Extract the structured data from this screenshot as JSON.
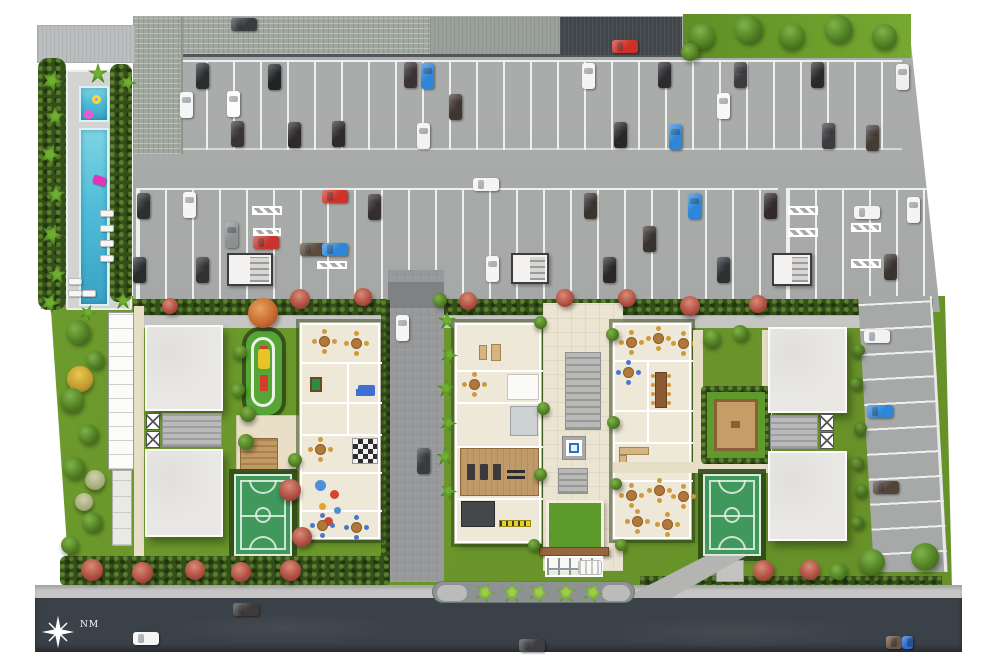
{
  "compass": {
    "label": "NM"
  },
  "palette": {
    "parking": "#a7a9a8",
    "stripe": "#eef0ee",
    "street": "#3b4148",
    "sidewalk": "#c6c7c5",
    "lawn": "#6f9e2d",
    "lawn_bright": "#76a832",
    "hedge": "#34501a",
    "water": "#4fbcd8",
    "water_light": "#7dd4e4",
    "deck": "#d3d4d2",
    "roof_light": "#bcbfc0",
    "roof_green": "#a0a89e",
    "roof_dark": "#41464a",
    "building": "#e9e8e4",
    "amenity": "#eee8d8",
    "court": "#41985c",
    "court_line": "#ddeadd",
    "wood": "#c09a68",
    "plaza": "#ebe4d1",
    "driveway": "#97999b",
    "median": "#8d9292",
    "fountain": "#2f6fc4",
    "canopy_beam": "#96683f",
    "chair_gold": "#d09a3c",
    "playground": "#55a636"
  },
  "scene": {
    "stripes": [
      [
        150,
        60,
        752,
        90,
        "v"
      ],
      [
        136,
        188,
        642,
        117,
        "v"
      ],
      [
        786,
        188,
        146,
        117,
        "v"
      ]
    ],
    "hatches": [
      [
        252,
        206,
        30,
        9
      ],
      [
        253,
        228,
        28,
        8
      ],
      [
        317,
        261,
        30,
        8
      ],
      [
        788,
        206,
        30,
        9
      ],
      [
        788,
        228,
        30,
        9
      ],
      [
        851,
        223,
        30,
        9
      ],
      [
        851,
        259,
        30,
        9
      ]
    ],
    "cores": [
      [
        227,
        253,
        46,
        33
      ],
      [
        511,
        253,
        38,
        31
      ],
      [
        772,
        253,
        40,
        33
      ]
    ],
    "loungers": [
      [
        100,
        210
      ],
      [
        100,
        225
      ],
      [
        100,
        240
      ],
      [
        100,
        255
      ],
      [
        68,
        278
      ],
      [
        68,
        290
      ],
      [
        82,
        290
      ]
    ],
    "cars": [
      [
        231,
        18,
        "h",
        "#3a3b3d"
      ],
      [
        612,
        40,
        "h",
        "#cf2f26"
      ],
      [
        196,
        63,
        "v",
        "#2c2d2f"
      ],
      [
        268,
        64,
        "v",
        "#232426"
      ],
      [
        404,
        62,
        "v",
        "#3b3236"
      ],
      [
        421,
        63,
        "v",
        "#2e86d8"
      ],
      [
        582,
        63,
        "v",
        "#f3f3f3"
      ],
      [
        658,
        62,
        "v",
        "#2c2c2e"
      ],
      [
        734,
        62,
        "v",
        "#3e3b40"
      ],
      [
        811,
        62,
        "v",
        "#2a2a2c"
      ],
      [
        896,
        64,
        "v",
        "#efefef"
      ],
      [
        180,
        92,
        "v",
        "#f5f5f5"
      ],
      [
        227,
        91,
        "v",
        "#fdfdfd"
      ],
      [
        449,
        94,
        "v",
        "#403630"
      ],
      [
        717,
        93,
        "v",
        "#f7f7f7"
      ],
      [
        231,
        121,
        "v",
        "#3a3336"
      ],
      [
        288,
        122,
        "v",
        "#2e292b"
      ],
      [
        332,
        121,
        "v",
        "#2f2a2c"
      ],
      [
        417,
        123,
        "v",
        "#f2f2f2"
      ],
      [
        614,
        122,
        "v",
        "#28282a"
      ],
      [
        669,
        124,
        "v",
        "#2e86d8"
      ],
      [
        822,
        123,
        "v",
        "#3c3c3e"
      ],
      [
        866,
        125,
        "v",
        "#463b33"
      ],
      [
        473,
        178,
        "h",
        "#f4f4f4"
      ],
      [
        137,
        193,
        "v",
        "#2e2f31"
      ],
      [
        183,
        192,
        "v",
        "#f4f4f4"
      ],
      [
        368,
        194,
        "v",
        "#342e31"
      ],
      [
        584,
        193,
        "v",
        "#3a332f"
      ],
      [
        688,
        193,
        "v",
        "#2e86d8"
      ],
      [
        764,
        193,
        "v",
        "#31292b"
      ],
      [
        907,
        197,
        "v",
        "#f4f4f4"
      ],
      [
        225,
        222,
        "v",
        "#8e9092"
      ],
      [
        322,
        190,
        "h",
        "#d03228"
      ],
      [
        253,
        236,
        "h",
        "#c8342c"
      ],
      [
        300,
        243,
        "h",
        "#5c4a3c"
      ],
      [
        322,
        243,
        "h",
        "#2e86d8"
      ],
      [
        643,
        226,
        "v",
        "#39332f"
      ],
      [
        854,
        206,
        "h",
        "#f3f3f3"
      ],
      [
        133,
        257,
        "v",
        "#2a2b2d"
      ],
      [
        196,
        257,
        "v",
        "#353033"
      ],
      [
        486,
        256,
        "v",
        "#f4f4f4"
      ],
      [
        603,
        257,
        "v",
        "#2b2628"
      ],
      [
        717,
        257,
        "v",
        "#2f3033"
      ],
      [
        884,
        254,
        "v",
        "#3b332d"
      ],
      [
        864,
        330,
        "h",
        "#f2f2f2"
      ],
      [
        867,
        405,
        "h",
        "#2e86d8"
      ],
      [
        873,
        481,
        "h",
        "#53443a"
      ],
      [
        396,
        315,
        "v",
        "#f5f5f5"
      ],
      [
        417,
        448,
        "v",
        "#3a3b3d"
      ],
      [
        133,
        632,
        "h",
        "#f4f4f4"
      ],
      [
        233,
        603,
        "h",
        "#3e3a38"
      ],
      [
        519,
        639,
        "h",
        "#3c3e40"
      ],
      [
        886,
        636,
        "h",
        "#6b5648",
        16
      ],
      [
        902,
        636,
        "h",
        "#2f6fd0",
        11
      ]
    ],
    "trees": [
      [
        "tree-green",
        702,
        36,
        26
      ],
      [
        "tree-green",
        748,
        29,
        28
      ],
      [
        "tree-green",
        792,
        36,
        26
      ],
      [
        "tree-green",
        838,
        29,
        28
      ],
      [
        "tree-green",
        884,
        36,
        25
      ],
      [
        "tree-green",
        690,
        52,
        18
      ],
      [
        "palm",
        52,
        80,
        22
      ],
      [
        "palm",
        55,
        116,
        20
      ],
      [
        "palm",
        50,
        154,
        22
      ],
      [
        "palm",
        56,
        194,
        20
      ],
      [
        "palm",
        52,
        234,
        22
      ],
      [
        "palm",
        57,
        274,
        20
      ],
      [
        "palm",
        50,
        302,
        20
      ],
      [
        "palm",
        98,
        73,
        20
      ],
      [
        "palm",
        128,
        82,
        18
      ],
      [
        "palm",
        123,
        300,
        18
      ],
      [
        "palm",
        88,
        312,
        16
      ],
      [
        "tree-green",
        78,
        332,
        24
      ],
      [
        "tree-yellow",
        80,
        379,
        26
      ],
      [
        "tree-green",
        95,
        360,
        18
      ],
      [
        "tree-green",
        72,
        400,
        24
      ],
      [
        "tree-green",
        88,
        434,
        20
      ],
      [
        "tree-pale",
        95,
        480,
        20
      ],
      [
        "tree-green",
        74,
        468,
        22
      ],
      [
        "tree-pale",
        84,
        502,
        18
      ],
      [
        "tree-green",
        92,
        522,
        20
      ],
      [
        "tree-green",
        70,
        545,
        18
      ],
      [
        "tree-red",
        170,
        306,
        16
      ],
      [
        "tree-red",
        300,
        299,
        20
      ],
      [
        "tree-red",
        363,
        297,
        18
      ],
      [
        "tree-red",
        468,
        301,
        18
      ],
      [
        "tree-red",
        565,
        298,
        18
      ],
      [
        "tree-red",
        627,
        298,
        18
      ],
      [
        "tree-orange",
        263,
        313,
        30
      ],
      [
        "tree-green",
        240,
        352,
        14
      ],
      [
        "tree-green",
        238,
        390,
        14
      ],
      [
        "tree-green",
        248,
        414,
        16
      ],
      [
        "tree-green",
        246,
        442,
        16
      ],
      [
        "tree-red",
        290,
        490,
        22
      ],
      [
        "tree-red",
        302,
        537,
        20
      ],
      [
        "tree-green",
        295,
        460,
        14
      ],
      [
        "palm",
        447,
        320,
        18
      ],
      [
        "palm",
        449,
        354,
        17
      ],
      [
        "palm",
        446,
        388,
        18
      ],
      [
        "palm",
        448,
        422,
        17
      ],
      [
        "palm",
        445,
        456,
        18
      ],
      [
        "palm",
        448,
        490,
        17
      ],
      [
        "tree-green",
        440,
        300,
        14
      ],
      [
        "tree-green",
        540,
        322,
        13
      ],
      [
        "tree-green",
        612,
        334,
        13
      ],
      [
        "tree-green",
        543,
        408,
        13
      ],
      [
        "tree-green",
        613,
        422,
        13
      ],
      [
        "tree-green",
        540,
        474,
        13
      ],
      [
        "tree-green",
        616,
        484,
        12
      ],
      [
        "tree-green",
        621,
        545,
        12
      ],
      [
        "tree-green",
        534,
        545,
        12
      ],
      [
        "tree-red",
        690,
        306,
        20
      ],
      [
        "tree-red",
        758,
        304,
        18
      ],
      [
        "tree-green",
        712,
        338,
        18
      ],
      [
        "tree-green",
        740,
        333,
        16
      ],
      [
        "shrub",
        858,
        350,
        13
      ],
      [
        "shrub",
        856,
        383,
        13
      ],
      [
        "shrub",
        860,
        428,
        13
      ],
      [
        "shrub",
        857,
        463,
        13
      ],
      [
        "shrub",
        861,
        490,
        13
      ],
      [
        "shrub",
        857,
        522,
        13
      ],
      [
        "tree-red",
        92,
        570,
        22
      ],
      [
        "tree-red",
        142,
        572,
        21
      ],
      [
        "tree-red",
        195,
        570,
        20
      ],
      [
        "tree-red",
        241,
        572,
        20
      ],
      [
        "tree-red",
        290,
        570,
        21
      ],
      [
        "tree-red",
        763,
        570,
        21
      ],
      [
        "tree-red",
        810,
        570,
        20
      ],
      [
        "tree-green",
        838,
        571,
        17
      ],
      [
        "tree-green",
        872,
        562,
        26
      ],
      [
        "tree-green",
        925,
        557,
        28
      ],
      [
        "palm-bright",
        485,
        592,
        20
      ],
      [
        "palm-bright",
        512,
        592,
        20
      ],
      [
        "palm-bright",
        539,
        592,
        20
      ],
      [
        "palm-bright",
        566,
        592,
        20
      ],
      [
        "palm-bright",
        593,
        592,
        20
      ]
    ]
  }
}
